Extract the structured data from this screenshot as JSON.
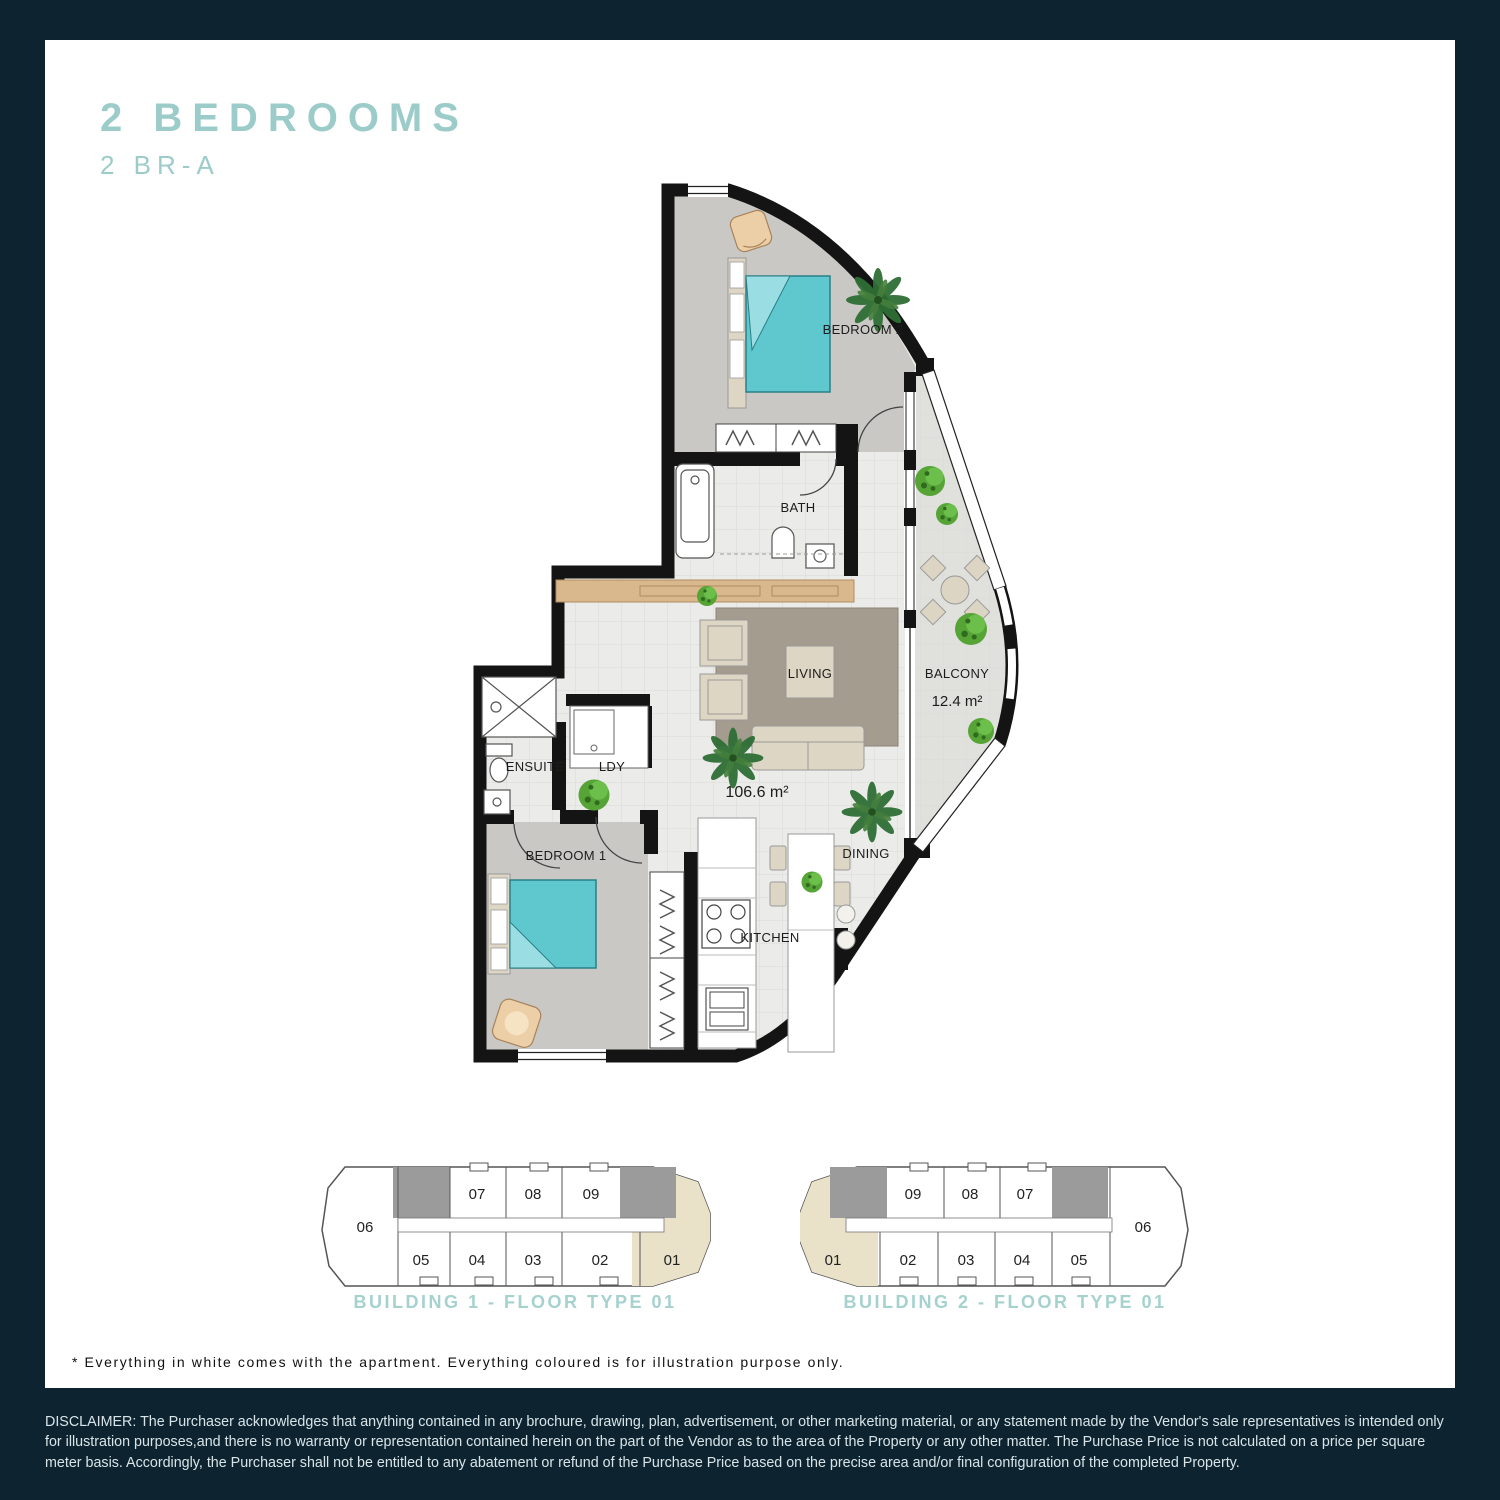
{
  "page": {
    "title": "2 BEDROOMS",
    "subtitle": "2 BR-A",
    "note": "* Everything in white comes with the apartment. Everything coloured is for illustration purpose only.",
    "disclaimer": "DISCLAIMER: The Purchaser acknowledges that anything contained in any brochure, drawing, plan, advertisement, or other marketing material, or any statement made by the Vendor's sale representatives is intended only for illustration purposes,and there is no warranty or representation contained herein on the part of the Vendor as to the area of the Property or any other matter. The Purchase Price is not calculated on a price per square meter basis. Accordingly, the Purchaser shall not be entitled to any abatement or refund of the Purchase Price based on the precise area and/or final configuration of the completed Property."
  },
  "floorplan": {
    "labels": {
      "bedroom2": "BEDROOM 2",
      "bath": "BATH",
      "balcony": "BALCONY",
      "balcony_area": "12.4 m²",
      "living": "LIVING",
      "apartment_area": "106.6 m²",
      "ensuite": "ENSUITE",
      "laundry": "LDY",
      "bedroom1": "BEDROOM 1",
      "kitchen": "KITCHEN",
      "dining": "DINING"
    }
  },
  "buildings": [
    {
      "caption": "BUILDING 1 - FLOOR TYPE 01",
      "end_unit": "06",
      "top_units": [
        "07",
        "08",
        "09"
      ],
      "bottom_units": [
        "05",
        "04",
        "03",
        "02"
      ],
      "highlight_unit": "01"
    },
    {
      "caption": "BUILDING 2 - FLOOR TYPE 01",
      "highlight_unit": "01",
      "top_units": [
        "09",
        "08",
        "07"
      ],
      "bottom_units": [
        "02",
        "03",
        "04",
        "05"
      ],
      "end_unit": "06"
    }
  ],
  "colors": {
    "frame": "#0d2430",
    "accent_teal": "#9cccc9",
    "caption_teal": "#a5d2cf",
    "unit_highlight": "#e9e1c8",
    "core_grey": "#9b9b9b",
    "bed_teal": "#5fc8ce",
    "wall_black": "#141414"
  }
}
